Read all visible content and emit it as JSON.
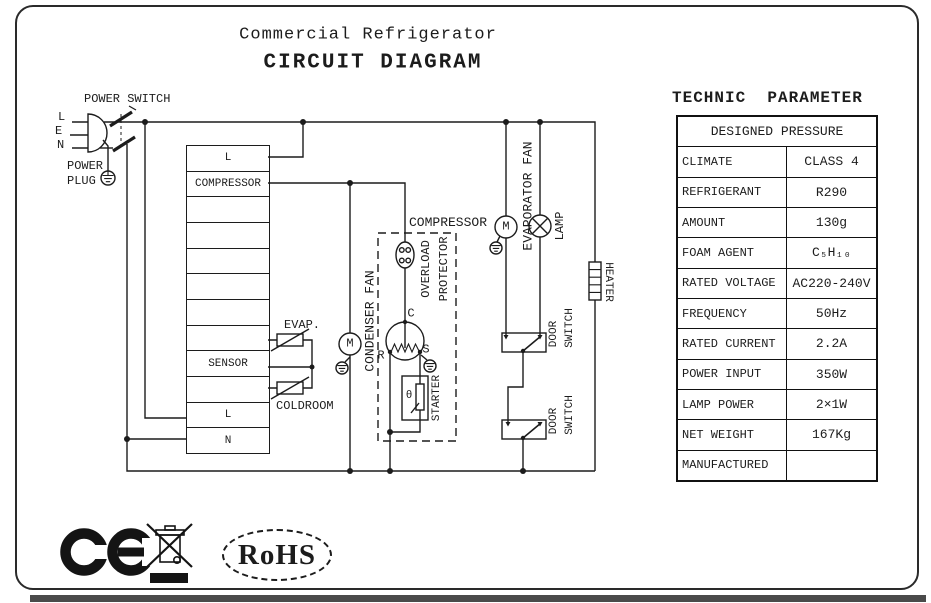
{
  "colors": {
    "ink": "#1c1c1c"
  },
  "title": {
    "product": "Commercial Refrigerator",
    "heading": "CIRCUIT DIAGRAM"
  },
  "power": {
    "switch": "POWER SWITCH",
    "plug_line1": "POWER",
    "plug_line2": "PLUG",
    "pin_l": "L",
    "pin_e": "E",
    "pin_n": "N"
  },
  "terminal_block": {
    "rows": [
      "L",
      "COMPRESSOR",
      "",
      "",
      "",
      "",
      "",
      "",
      "SENSOR",
      "",
      "L",
      "N"
    ]
  },
  "sensors": {
    "evap": "EVAP.",
    "coldroom": "COLDROOM"
  },
  "compressor_unit": {
    "box_label": "COMPRESSOR",
    "overload_line1": "OVERLOAD",
    "overload_line2": "PROTECTOR",
    "starter": "STARTER",
    "theta": "θ",
    "terminal_c": "C",
    "terminal_r": "R",
    "terminal_s": "S"
  },
  "fans": {
    "condenser_label": "CONDENSER FAN",
    "evaporator_label": "EVAPORATOR FAN",
    "condenser_motor": "M",
    "evaporator_motor": "M"
  },
  "lamp": {
    "label": "LAMP"
  },
  "heater": {
    "label": "HEATER"
  },
  "door_switches": {
    "sw1_line1": "DOOR",
    "sw1_line2": "SWITCH",
    "sw2_line1": "DOOR",
    "sw2_line2": "SWITCH"
  },
  "parameters": {
    "heading": "TECHNIC  PARAMETER",
    "span_row": "DESIGNED PRESSURE",
    "rows": [
      {
        "label": "CLIMATE",
        "value": "CLASS 4"
      },
      {
        "label": "REFRIGERANT",
        "value": "R290"
      },
      {
        "label": "AMOUNT",
        "value": "130g"
      },
      {
        "label": "FOAM AGENT",
        "value": "C₅H₁₀"
      },
      {
        "label": "RATED VOLTAGE",
        "value": "AC220-240V"
      },
      {
        "label": "FREQUENCY",
        "value": "50Hz"
      },
      {
        "label": "RATED CURRENT",
        "value": "2.2A"
      },
      {
        "label": "POWER INPUT",
        "value": "350W"
      },
      {
        "label": "LAMP POWER",
        "value": "2×1W"
      },
      {
        "label": "NET WEIGHT",
        "value": "167Kg"
      },
      {
        "label": "MANUFACTURED",
        "value": ""
      }
    ]
  },
  "certifications": {
    "rohs": "RoHS"
  }
}
